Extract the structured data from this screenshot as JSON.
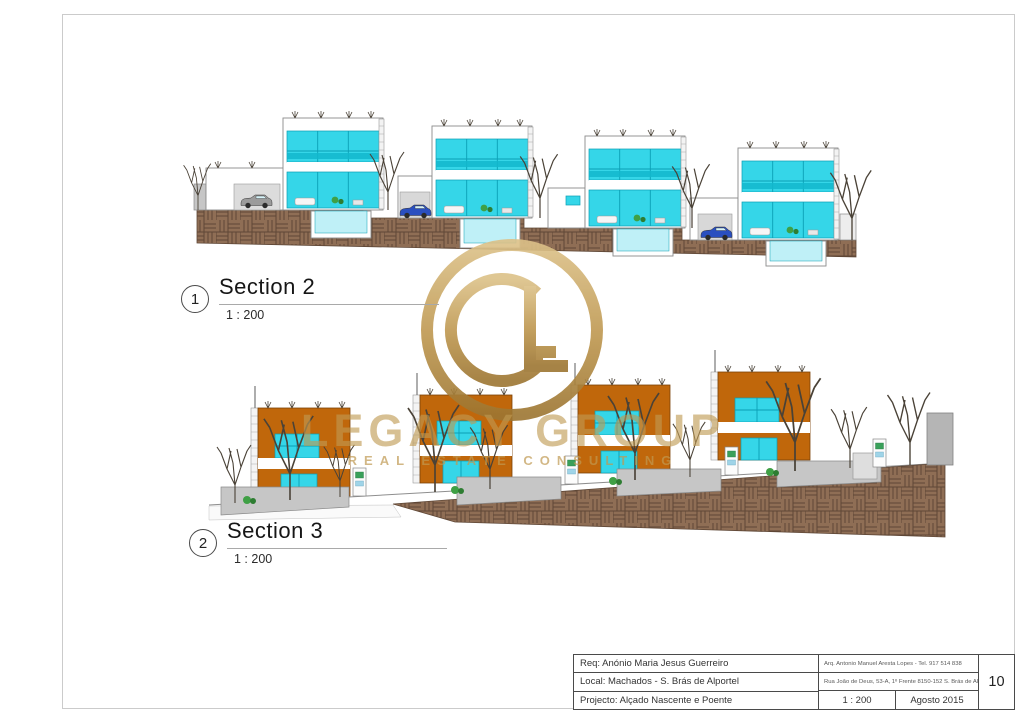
{
  "sections": [
    {
      "number": "1",
      "title": "Section 2",
      "scale": "1 : 200"
    },
    {
      "number": "2",
      "title": "Section 3",
      "scale": "1 : 200"
    }
  ],
  "watermark": {
    "monogram": "GL",
    "title": "LEGACY GROUP",
    "subtitle": "REAL ESTATE CONSULTING"
  },
  "title_block": {
    "req": "Req: Anónio Maria Jesus Guerreiro",
    "local": "Local: Machados - S. Brás de Alportel",
    "projecto": "Projecto: Alçado Nascente e Poente",
    "arq_line1": "Arq. Antonio Manuel Aresta Lopes - Tel. 917 514 838",
    "arq_line2": "Rua João de Deus, 53-A, 1º Frente 8150-152 S. Brás de Alportel",
    "scale": "1 : 200",
    "date": "Agosto 2015",
    "sheet": "10"
  },
  "colors": {
    "glazing": "#35d6e8",
    "glazing_dark": "#0b9fb5",
    "pool": "#bff0f7",
    "facade_orange": "#c0670b",
    "earth": "#8f6e55",
    "earth_dark": "#5f4736",
    "gold": "#c09a52",
    "tree": "#4a4237"
  }
}
